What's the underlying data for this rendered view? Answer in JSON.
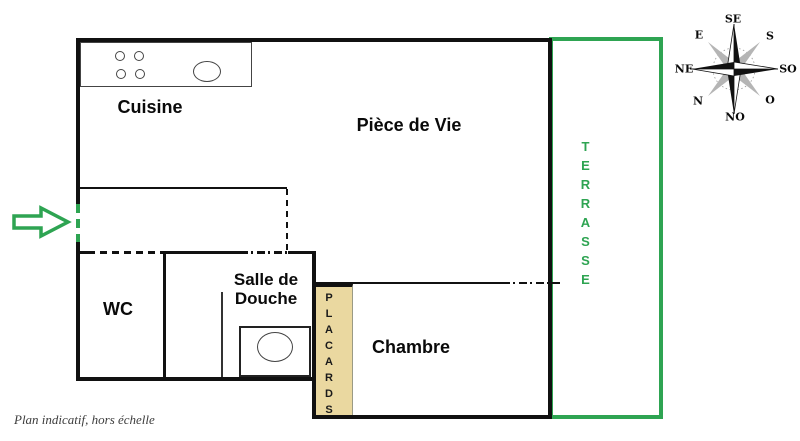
{
  "plan": {
    "rooms": {
      "cuisine": "Cuisine",
      "piece_de_vie": "Pièce de Vie",
      "wc": "WC",
      "salle_de_douche_line1": "Salle de",
      "salle_de_douche_line2": "Douche",
      "chambre": "Chambre",
      "placards": "PLACARDS",
      "terrasse": "TERRASSE"
    },
    "caption": "Plan indicatif, hors échelle",
    "compass": {
      "labels": {
        "se": "SE",
        "e": "E",
        "s": "S",
        "ne": "NE",
        "so": "SO",
        "n": "N",
        "o": "O",
        "no": "NO"
      }
    },
    "colors": {
      "accent_green": "#2ea452",
      "placards_fill": "#ead8a0",
      "wall": "#111111"
    }
  }
}
